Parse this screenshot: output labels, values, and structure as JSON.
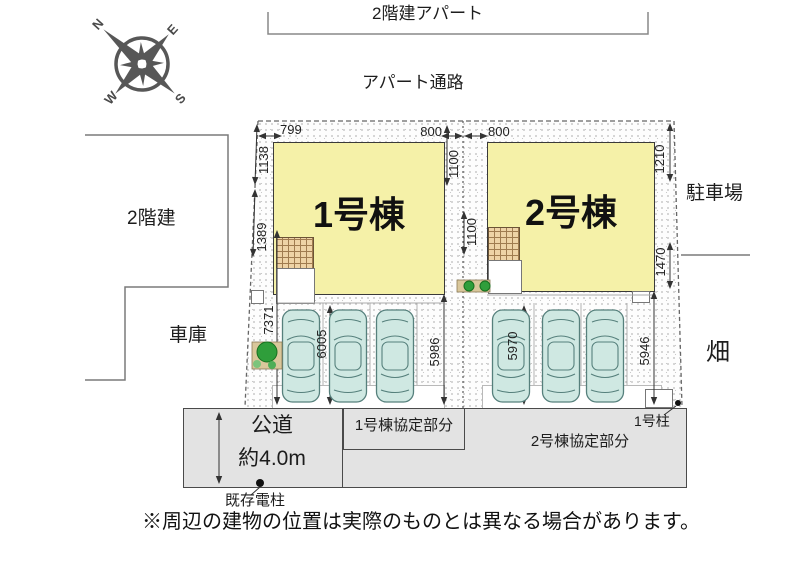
{
  "compass": {
    "n": "N",
    "e": "E",
    "s": "S",
    "w": "W"
  },
  "neighbors": {
    "apartment": "2階建アパート",
    "apartment_path": "アパート通路",
    "two_story": "2階建",
    "garage": "車庫",
    "parking_lot": "駐車場",
    "field": "畑"
  },
  "buildings": {
    "b1": "1号棟",
    "b2": "2号棟"
  },
  "dims": {
    "top_left": "799",
    "top_b1": "800",
    "top_b2": "800",
    "left_upper": "1138",
    "left_mid": "1389",
    "left_lower": "7371",
    "divider_upper": "1100",
    "divider_lower": "1100",
    "right_upper": "1210",
    "right_lower": "1470",
    "stall_b1_left": "6005",
    "stall_b1_right": "5986",
    "stall_b2_left": "5970",
    "stall_b2_right": "5946"
  },
  "road": {
    "label": "公道",
    "width_label": "約4.0m",
    "b1_agreement": "1号棟協定部分",
    "b2_agreement": "2号棟協定部分",
    "pole": "1号柱",
    "existing_pole": "既存電柱"
  },
  "note": "※周辺の建物の位置は実際のものとは異なる場合があります。"
}
